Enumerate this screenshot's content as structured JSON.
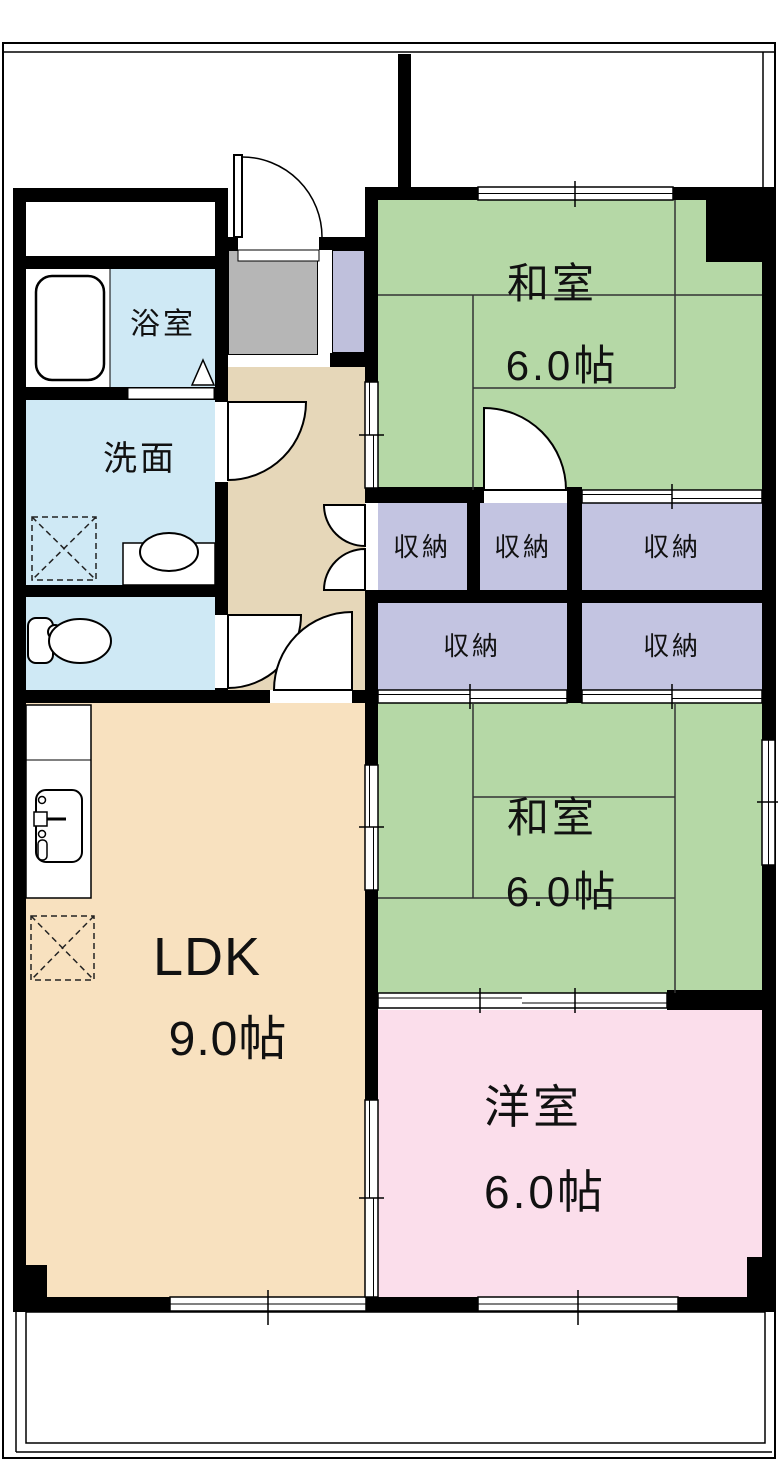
{
  "unit": {
    "rooms": {
      "washitsu_top": {
        "label": "和室",
        "size": "6.0帖"
      },
      "washitsu_mid": {
        "label": "和室",
        "size": "6.0帖"
      },
      "yoshitsu": {
        "label": "洋室",
        "size": "6.0帖"
      },
      "ldk": {
        "label": "LDK",
        "size": "9.0帖"
      },
      "bath": {
        "label": "浴室"
      },
      "washroom": {
        "label": "洗面"
      }
    },
    "closets": [
      "収納",
      "収納",
      "収納",
      "収納",
      "収納"
    ],
    "fixtures": [
      "bathtub",
      "wash-basin",
      "washing-machine-space",
      "toilet",
      "kitchen-sink",
      "refrigerator-space",
      "entry-door",
      "room-doors",
      "sliding-doors",
      "windows",
      "balcony"
    ],
    "colors": {
      "tatami": "#b5d8a6",
      "closet": "#c3c4e1",
      "western_room": "#fbdeeb",
      "ldk": "#f8e1bf",
      "hallway": "#e6d7b9",
      "wet_area": "#cfe9f5",
      "genkan": "#b6b6b6",
      "shoe_cabinet": "#bfc0dc",
      "wall": "#000000"
    }
  }
}
